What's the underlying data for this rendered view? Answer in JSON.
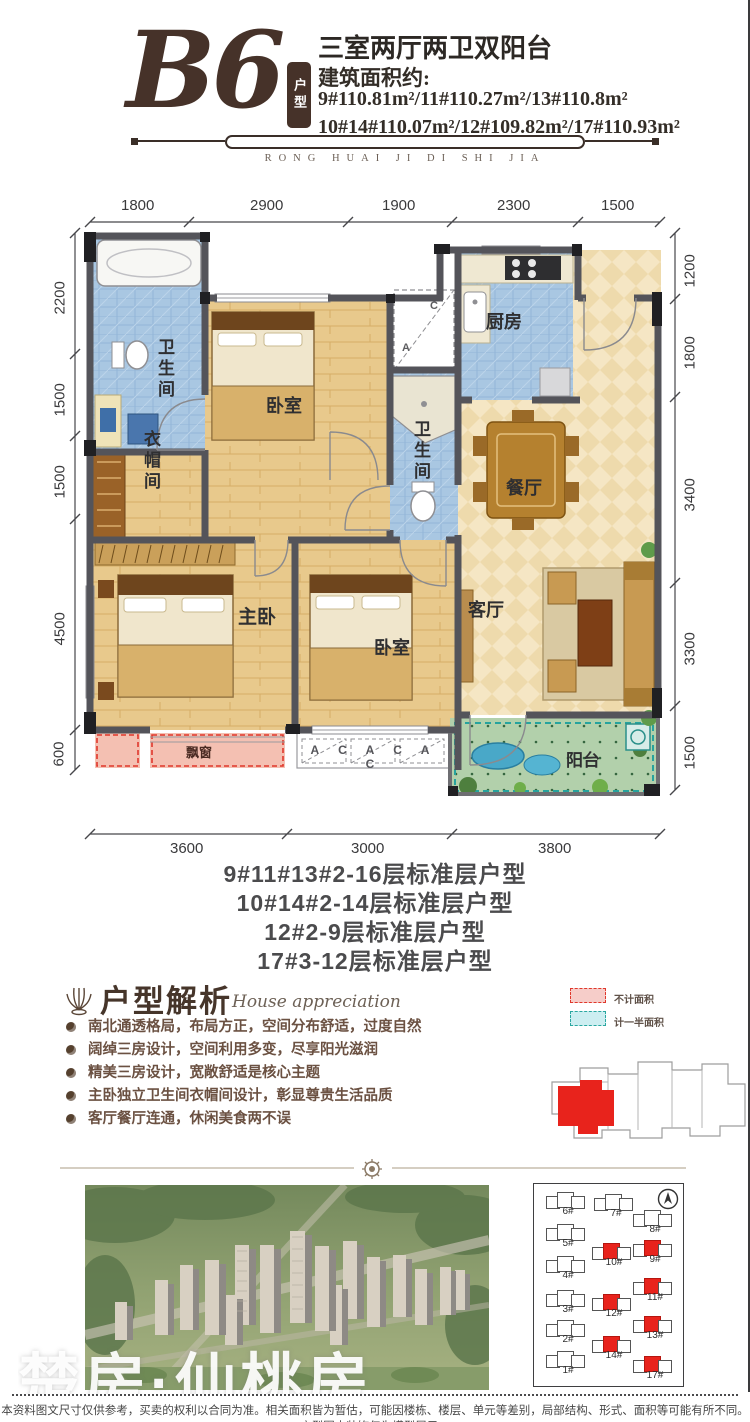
{
  "header": {
    "plan_code": "B6",
    "badge_vertical": "户型",
    "title": "三室两厅两卫双阳台",
    "area_label": "建筑面积约:",
    "area_line1": "9#110.81m²/11#110.27m²/13#110.8m²",
    "area_line2": "10#14#110.07m²/12#109.82m²/17#110.93m²",
    "brand_letters": "RONG HUAI JI DI SHI JIA"
  },
  "floor_plan": {
    "rooms": {
      "bath1": "卫生间",
      "closet": "衣帽间",
      "master": "主卧",
      "bedroom1": "卧室",
      "bath2": "卫生间",
      "bedroom2": "卧室",
      "kitchen": "厨房",
      "dining": "餐厅",
      "living": "客厅",
      "balcony": "阳台",
      "bay_window": "飘窗"
    },
    "ac_top": {
      "c": "C",
      "a": "A"
    },
    "ac_row": "A C A C A C",
    "dims": {
      "top": [
        "1800",
        "2900",
        "1900",
        "2300",
        "1500"
      ],
      "bottom": [
        "3600",
        "3000",
        "3800"
      ],
      "left": [
        "2200",
        "1500",
        "1500",
        "4500",
        "600"
      ],
      "right": [
        "1200",
        "1800",
        "3400",
        "3300",
        "1500"
      ]
    }
  },
  "standard_floors": [
    "9#11#13#2-16层标准层户型",
    "10#14#2-14层标准层户型",
    "12#2-9层标准层户型",
    "17#3-12层标准层户型"
  ],
  "analysis": {
    "title": "户型解析",
    "subtitle": "House appreciation",
    "bullets": [
      "南北通透格局，布局方正，空间分布舒适，过度自然",
      "阔绰三房设计，空间利用多变，尽享阳光滋润",
      "精美三房设计，宽敞舒适是核心主题",
      "主卧独立卫生间衣帽间设计，彰显尊贵生活品质",
      "客厅餐厅连通，休闲美食两不误"
    ]
  },
  "legend": {
    "no_area": "不计面积",
    "half_area": "计一半面积"
  },
  "site_plan": {
    "buildings": [
      {
        "id": "6#",
        "highlight": false
      },
      {
        "id": "7#",
        "highlight": false
      },
      {
        "id": "8#",
        "highlight": false
      },
      {
        "id": "5#",
        "highlight": false
      },
      {
        "id": "9#",
        "highlight": true
      },
      {
        "id": "10#",
        "highlight": true
      },
      {
        "id": "4#",
        "highlight": false
      },
      {
        "id": "11#",
        "highlight": true
      },
      {
        "id": "3#",
        "highlight": false
      },
      {
        "id": "12#",
        "highlight": true
      },
      {
        "id": "13#",
        "highlight": true
      },
      {
        "id": "2#",
        "highlight": false
      },
      {
        "id": "14#",
        "highlight": true
      },
      {
        "id": "1#",
        "highlight": false
      },
      {
        "id": "17#",
        "highlight": true
      }
    ]
  },
  "watermark": "楚房·仙桃房",
  "footer": "本资料图文尺寸仅供参考，买卖的权利以合同为准。相关面积皆为暂估，可能因楼栋、楼层、单元等差别，局部结构、形式、面积等可能有所不同。户型图中装饰仅为模型展示。"
}
